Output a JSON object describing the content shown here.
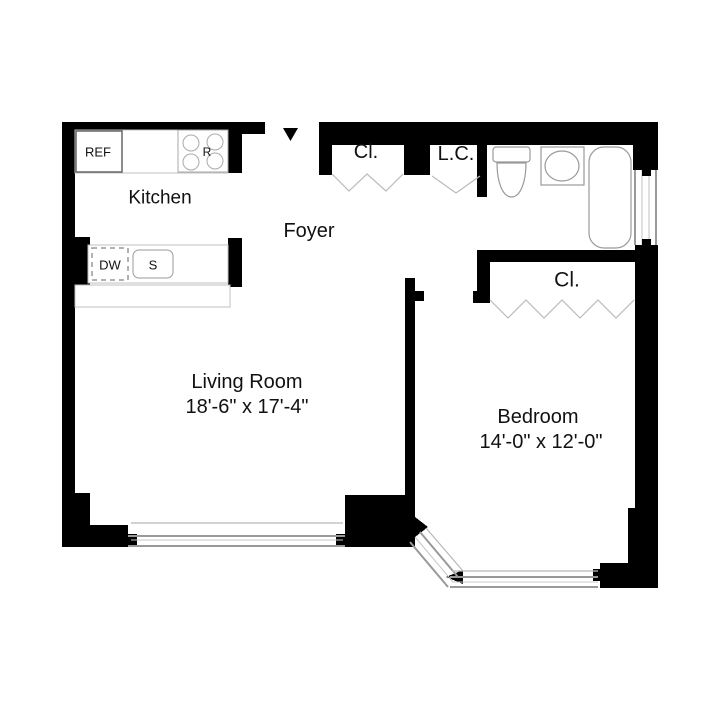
{
  "floorplan": {
    "rooms": {
      "kitchen": {
        "label": "Kitchen"
      },
      "foyer": {
        "label": "Foyer"
      },
      "living_room": {
        "label": "Living Room",
        "dimensions": "18'-6\" x 17'-4\""
      },
      "bedroom": {
        "label": "Bedroom",
        "dimensions": "14'-0\" x 12'-0\""
      }
    },
    "closets": {
      "foyer_closet": {
        "label": "Cl."
      },
      "linen_closet": {
        "label": "L.C."
      },
      "bedroom_closet": {
        "label": "Cl."
      }
    },
    "kitchen_fixtures": {
      "refrigerator": {
        "label": "REF"
      },
      "range": {
        "label": "R"
      },
      "dishwasher": {
        "label": "DW"
      },
      "sink": {
        "label": "S"
      }
    },
    "bathroom_fixtures": {
      "toilet": "toilet",
      "sink": "sink",
      "bathtub": "bathtub"
    },
    "entry": {
      "arrow_icon": "down-triangle"
    },
    "colors": {
      "wall": "#000000",
      "background": "#ffffff",
      "fixture_outline": "#999999",
      "counter_outline": "#c0c0c0",
      "window_line": "#b0b0b0",
      "text": "#111111"
    }
  }
}
